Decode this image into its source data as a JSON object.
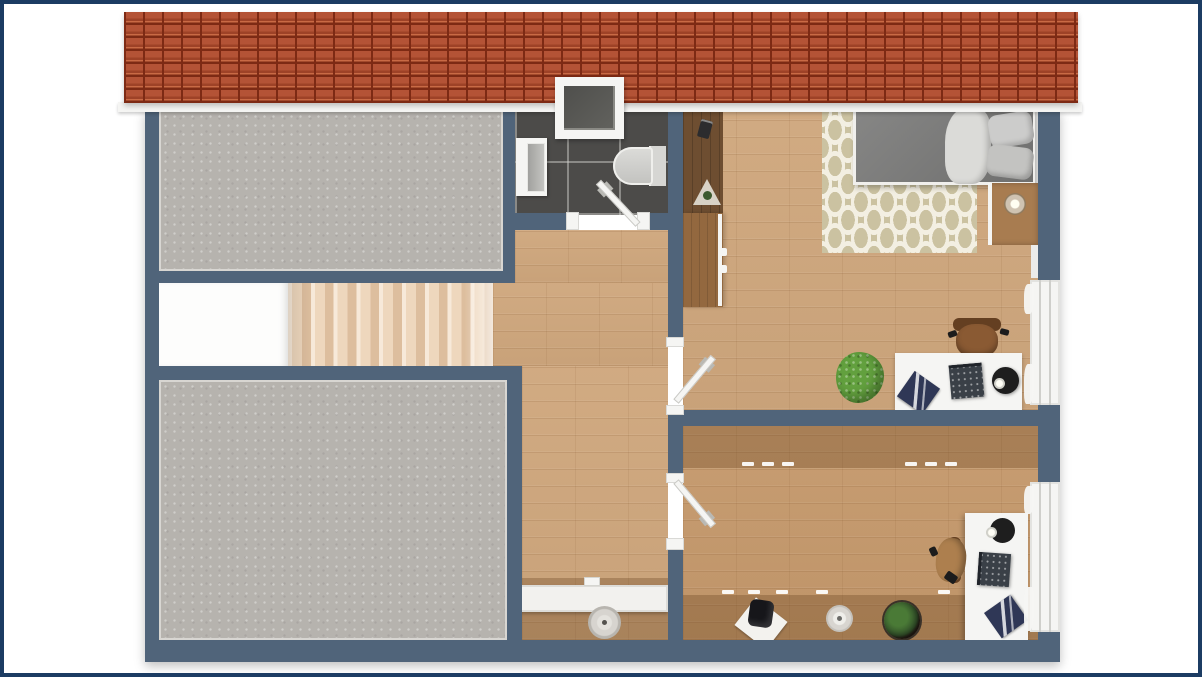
{
  "meta": {
    "description": "3D rendered top-down floor plan of an attic storey, no visible text labels",
    "view": "top-down"
  },
  "colors": {
    "frame": "#1c3c63",
    "canvas": "#ffffff",
    "wall": "#50647a",
    "trim": "#f5f5f3",
    "roof": "#b04a2b",
    "roof_dark": "#7d2a14",
    "roof_light": "#c96a45",
    "concrete": "#b6b3ae",
    "concrete_edge": "#d8d6d2",
    "wood": "#cfa77d",
    "wood_office": "#c5996c",
    "walnut": "#6e4e31",
    "dresser_wood": "#93683f",
    "nightstand_wood": "#a87c50",
    "tile": "#4c4b49",
    "landing": "#fdfdfc",
    "rug": "#cbc2a1",
    "rug_pattern": "#f3efe2",
    "bed": "#7b7b7a",
    "pillow": "#cccccb",
    "sheet": "#dbdbd8",
    "chair_brown": "#8a5a33",
    "chair_tan": "#ad7f4e",
    "chair_dark": "#643f21",
    "plant_green": "#62a03e",
    "plant_dark": "#33512a",
    "device": "#3a4047",
    "magazine": "#2f3756",
    "lamp": "#1e1e1e",
    "radiator": "#f2f1ee",
    "pouf": "#d7d4cf"
  },
  "scene": {
    "roof": {
      "features": [
        "red-tile-roof-strip",
        "skylight-window"
      ]
    },
    "rooms": [
      {
        "name": "storage-room-upper-left",
        "floor": "gray-concrete",
        "furniture": []
      },
      {
        "name": "storage-room-lower-left",
        "floor": "gray-concrete",
        "furniture": []
      },
      {
        "name": "staircase",
        "features": [
          "white-landing",
          "nine-step-flight"
        ]
      },
      {
        "name": "bathroom",
        "floor": "dark-tile",
        "fixtures": [
          "vanity-sink",
          "toilet",
          "skylight-above",
          "door-to-hallway"
        ]
      },
      {
        "name": "bedroom",
        "floor": "light-wood",
        "furniture": [
          "double-bed",
          "two-pillows",
          "white-throw",
          "patterned-rug",
          "nightstand",
          "round-table-lamp",
          "tall-wardrobe",
          "dresser",
          "white-desk",
          "brown-office-chair",
          "desk-lamp",
          "laptop",
          "magazine",
          "green-plant"
        ]
      },
      {
        "name": "office",
        "floor": "light-wood-with-sloped-ceiling-bands",
        "furniture": [
          "white-desk",
          "tan-office-chair",
          "desk-lamp",
          "monitor",
          "magazine",
          "potted-plant",
          "round-plate",
          "mug-on-papers"
        ],
        "markers": [
          "dashed-ceiling-height-lines"
        ]
      },
      {
        "name": "hallway",
        "floor": "light-wood",
        "furniture": [
          "white-sideboard",
          "knitted-pouf"
        ]
      }
    ],
    "doors": [
      "bathroom-door",
      "bedroom-door",
      "office-door"
    ],
    "windows": [
      "bedroom-window-right-wall",
      "office-window-right-wall",
      "roof-skylight"
    ]
  }
}
